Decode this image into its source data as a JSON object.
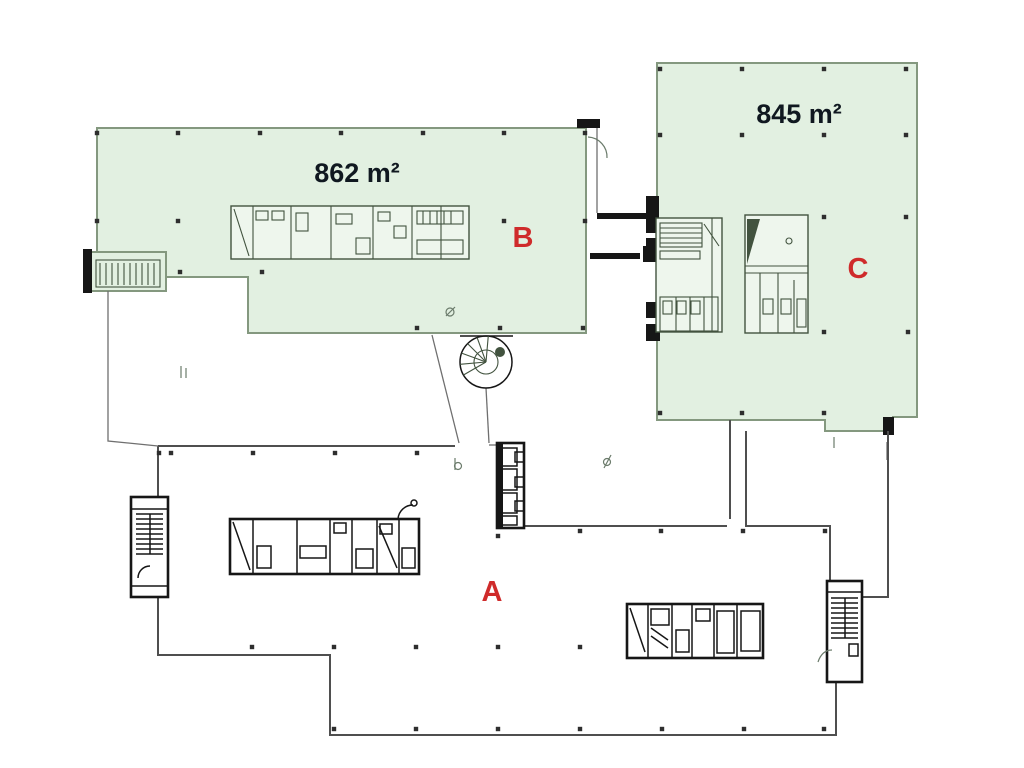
{
  "plan": {
    "sections": {
      "a": {
        "label": "A"
      },
      "b": {
        "label": "B",
        "area": "862 m²"
      },
      "c": {
        "label": "C",
        "area": "845 m²"
      }
    },
    "colors": {
      "highlight_fill": "#e2f0e1",
      "highlight_stroke": "#84987f",
      "section_letter": "#cf2b2b",
      "area_text": "#101820",
      "wall": "#161616",
      "outline": "#4f4f4f",
      "detail_line": "#42533f"
    }
  }
}
